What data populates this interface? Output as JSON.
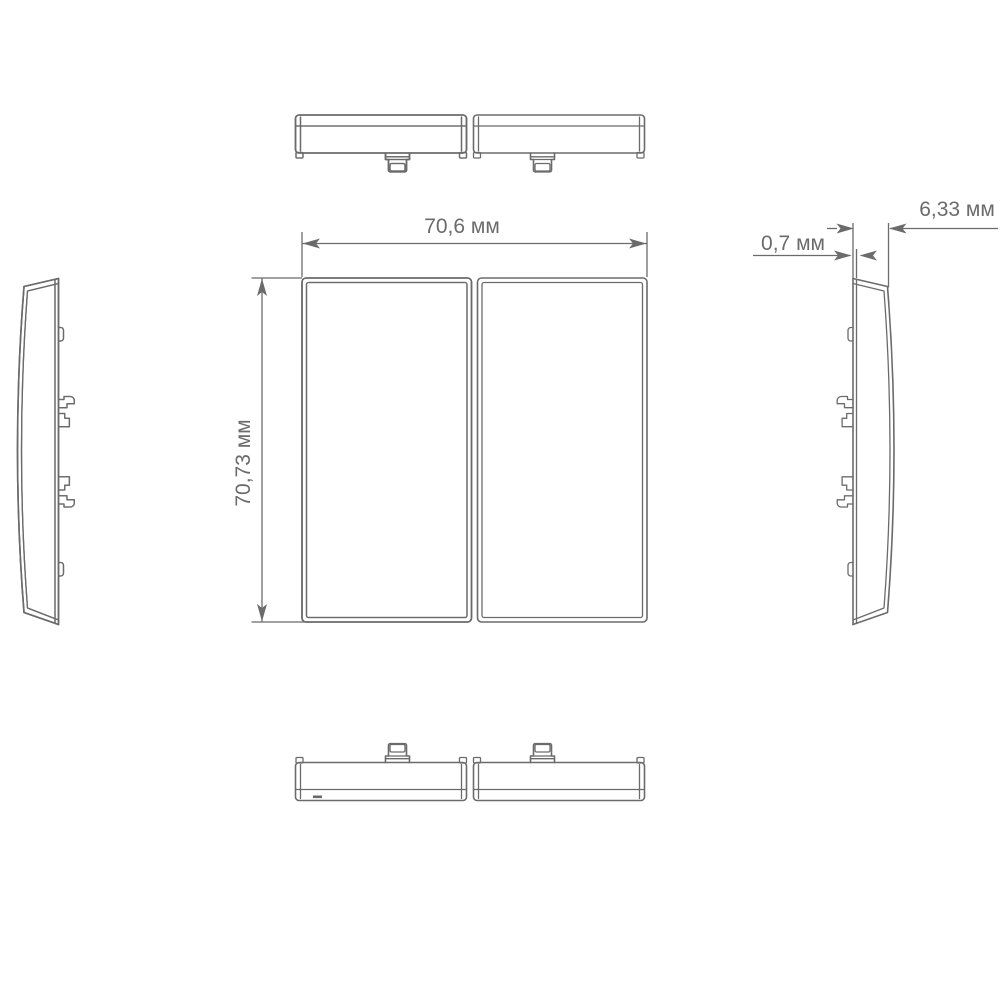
{
  "dimensions": {
    "width": {
      "label": "70,6 мм",
      "value_mm": 70.6
    },
    "height": {
      "label": "70,73 мм",
      "value_mm": 70.73
    },
    "front_thickness": {
      "label": "0,7 мм",
      "value_mm": 0.7
    },
    "depth": {
      "label": "6,33 мм",
      "value_mm": 6.33
    }
  },
  "colors": {
    "line": "#6b6b6b",
    "text": "#6b6b6b",
    "background": "#ffffff"
  }
}
